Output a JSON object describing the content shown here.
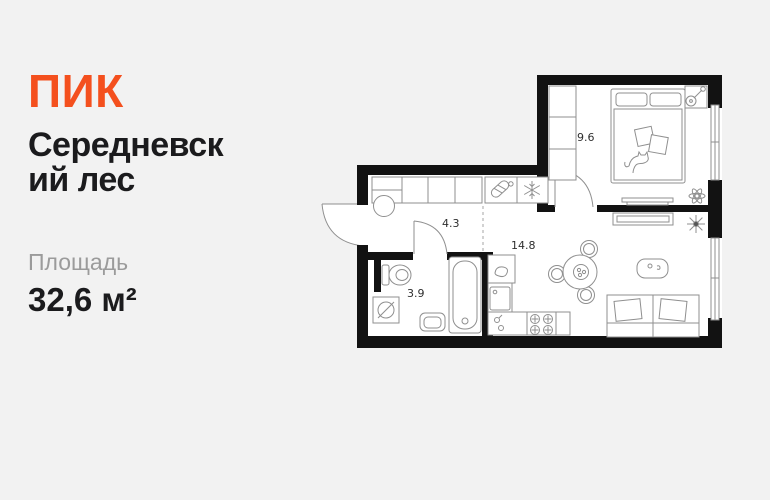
{
  "card": {
    "logo": "ПИК",
    "title_line1": "Середневск",
    "title_line2": "ий лес",
    "area_label": "Площадь",
    "area_value": "32,6 м²",
    "colors": {
      "accent_orange": "#F4501E",
      "background": "#F2F2F2",
      "text_dark": "#1B1B1D",
      "text_gray": "#9B9B9B",
      "walls": "#121212",
      "furniture_lines": "#8F8F8F"
    }
  },
  "floor_plan": {
    "rooms": {
      "bedroom": {
        "area": "9.6"
      },
      "hallway": {
        "area": "4.3"
      },
      "kitchen_living": {
        "area": "14.8"
      },
      "bathroom": {
        "area": "3.9"
      }
    },
    "icons": [
      "smart-lock-icon",
      "snowflake-ac-icon",
      "water-heater-icon",
      "plant-icon",
      "plant-star-icon"
    ]
  }
}
